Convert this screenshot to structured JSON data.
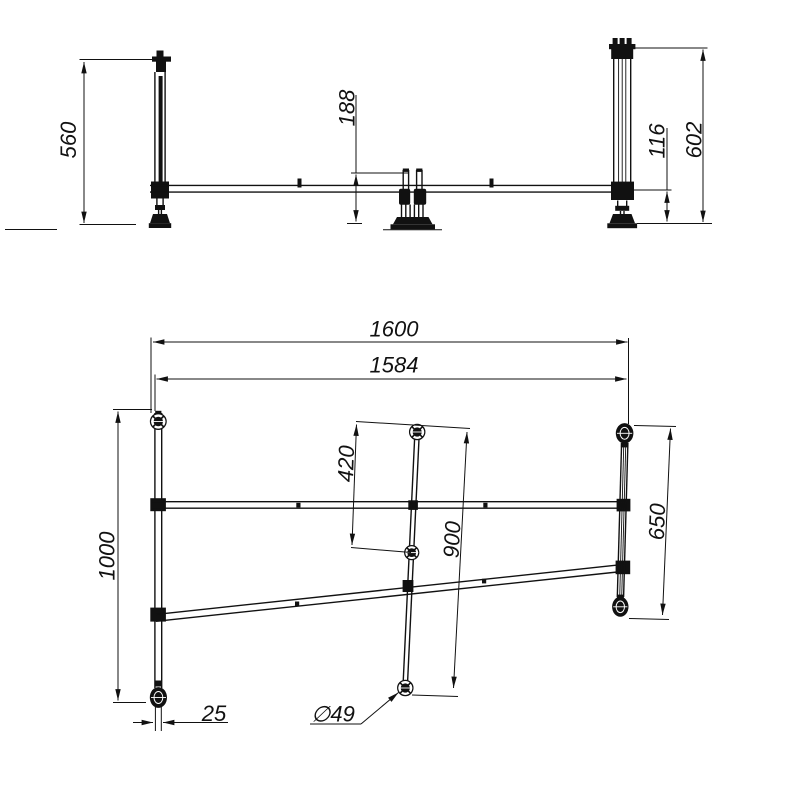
{
  "drawing": {
    "background_color": "#ffffff",
    "line_color": "#111111",
    "dims": {
      "front_height_left": "560",
      "front_center_height": "188",
      "front_underbeam_height": "116",
      "front_height_right": "602",
      "plan_overall_length": "1600",
      "plan_inner_length": "1584",
      "plan_offset_top": "420",
      "plan_center_span": "900",
      "plan_right_span": "650",
      "plan_width": "1000",
      "plan_tube_width": "25",
      "plan_foot_diameter": "∅49"
    }
  }
}
